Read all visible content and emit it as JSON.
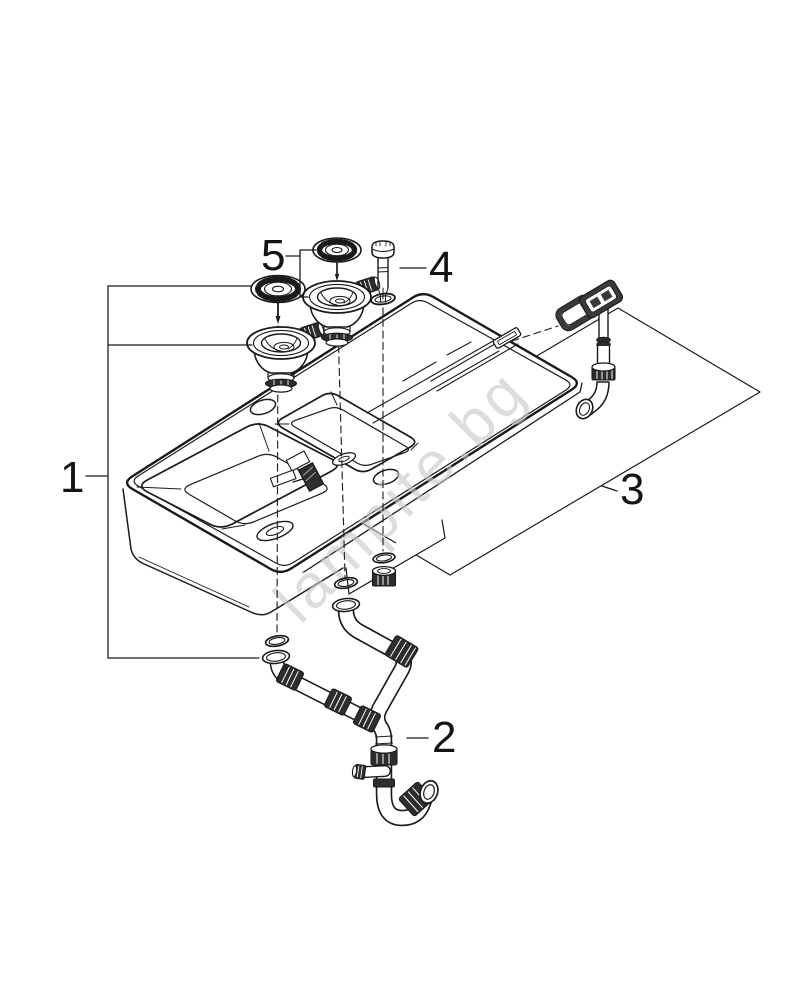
{
  "figure": {
    "background": "#ffffff",
    "line_color": "#1a1a1a",
    "watermark": {
      "text": "lampite.bg",
      "color": "#c8c8c8"
    },
    "callouts": [
      {
        "label": "1"
      },
      {
        "label": "2"
      },
      {
        "label": "3"
      },
      {
        "label": "4"
      },
      {
        "label": "5"
      }
    ]
  }
}
